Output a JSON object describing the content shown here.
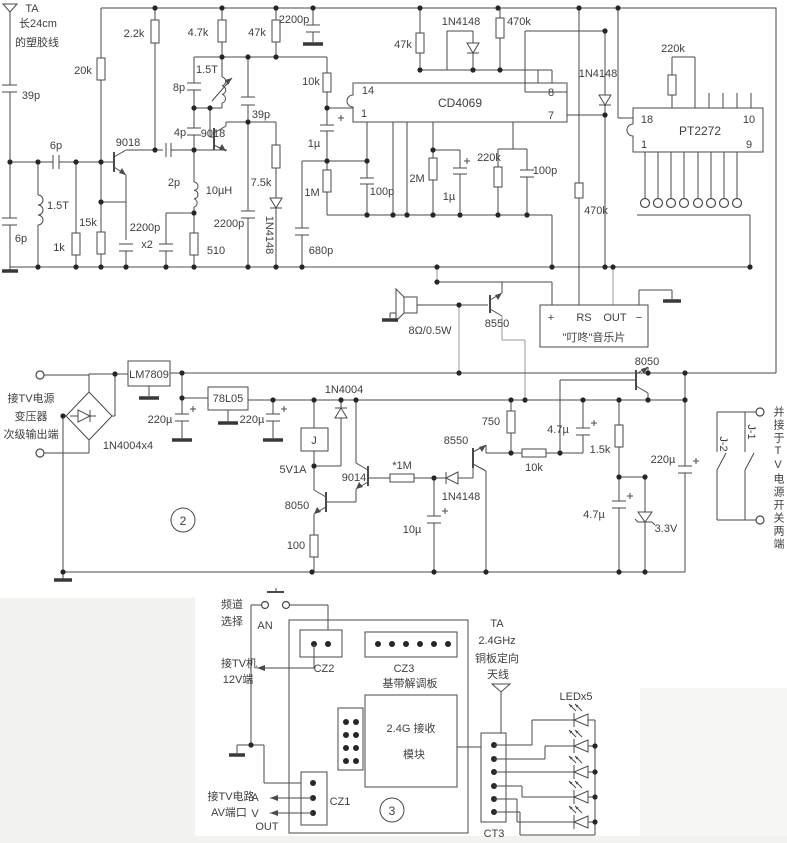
{
  "s1": {
    "ta": "TA",
    "len": "长24cm",
    "wire": "的塑胶线",
    "c39a": "39p",
    "c6a": "6p",
    "l15a": "1.5T",
    "c6b": "6p",
    "r1k": "1k",
    "r15k": "15k",
    "r20k": "20k",
    "r2k2": "2.2k",
    "q1": "9018",
    "c2p": "2p",
    "c2200_1": "2200p",
    "c2200_x2": "x2",
    "c2200_2": "2200p",
    "c2200_top": "2200p",
    "r510": "510",
    "l10u": "10µH",
    "c8p": "8p",
    "c4p": "4p",
    "l15b": "1.5T",
    "q2": "9018",
    "c39b": "39p",
    "r4k7": "4.7k",
    "r47a": "47k",
    "r7k5": "7.5k",
    "d1": "1N4148",
    "r10k": "10k",
    "ic1": "CD4069",
    "p14": "14",
    "p1": "1",
    "p8": "8",
    "p7": "7",
    "r47b": "47k",
    "d2": "1N4148",
    "r470a": "470k",
    "c1ua": "1µ",
    "r1m": "1M",
    "c100a": "100p",
    "r2m": "2M",
    "c1ub": "1µ",
    "r220a": "220k",
    "c100b": "100p",
    "c680": "680p",
    "d3": "1N4148",
    "r220b": "220k",
    "ic2": "PT2272",
    "p18": "18",
    "p1b": "1",
    "p10": "10",
    "p9": "9",
    "r470b": "470k",
    "spk": "8Ω/0.5W",
    "q3": "8550",
    "mc_p": "+",
    "mc_rs": "RS",
    "mc_out": "OUT",
    "mc_m": "−",
    "mc": "\"叮咚\"音乐片",
    "q4": "8050"
  },
  "s2": {
    "t1": "接TV电源",
    "t2": "变压器",
    "t3": "次级输出端",
    "bridge": "1N4004x4",
    "reg9": "LM7809",
    "c220a": "220µ",
    "reg5": "78L05",
    "c220b": "220µ",
    "d4": "1N4004",
    "relay": "J",
    "spec": "5V1A",
    "q5": "9014",
    "r1m": "*1M",
    "q6": "8050",
    "r100": "100",
    "c10u": "10µ",
    "d5": "1N4148",
    "q7": "8550",
    "r750": "750",
    "r10k": "10k",
    "c47a": "4.7µ",
    "r1k5": "1.5k",
    "c220c": "220µ",
    "c47b": "4.7µ",
    "dz": "3.3V",
    "j1": "J-1",
    "j2": "J-2",
    "note": "并接于TV电源开关两端",
    "num": "2"
  },
  "s3": {
    "ch1": "频道",
    "ch2": "选择",
    "an": "AN",
    "cz2": "CZ2",
    "cz3": "CZ3",
    "board": "基带解调板",
    "tv1": "接TV机",
    "tv2": "12V端",
    "ta": "TA",
    "ghz": "2.4GHz",
    "cu": "铜板定向",
    "ant": "天线",
    "mod1": "2.4G 接收",
    "mod2": "模块",
    "cz1": "CZ1",
    "av0": "接TV电路",
    "av1": "AV端口",
    "a": "A",
    "v": "V",
    "out": "OUT",
    "led": "LEDx5",
    "ct3": "CT3",
    "num": "3"
  }
}
